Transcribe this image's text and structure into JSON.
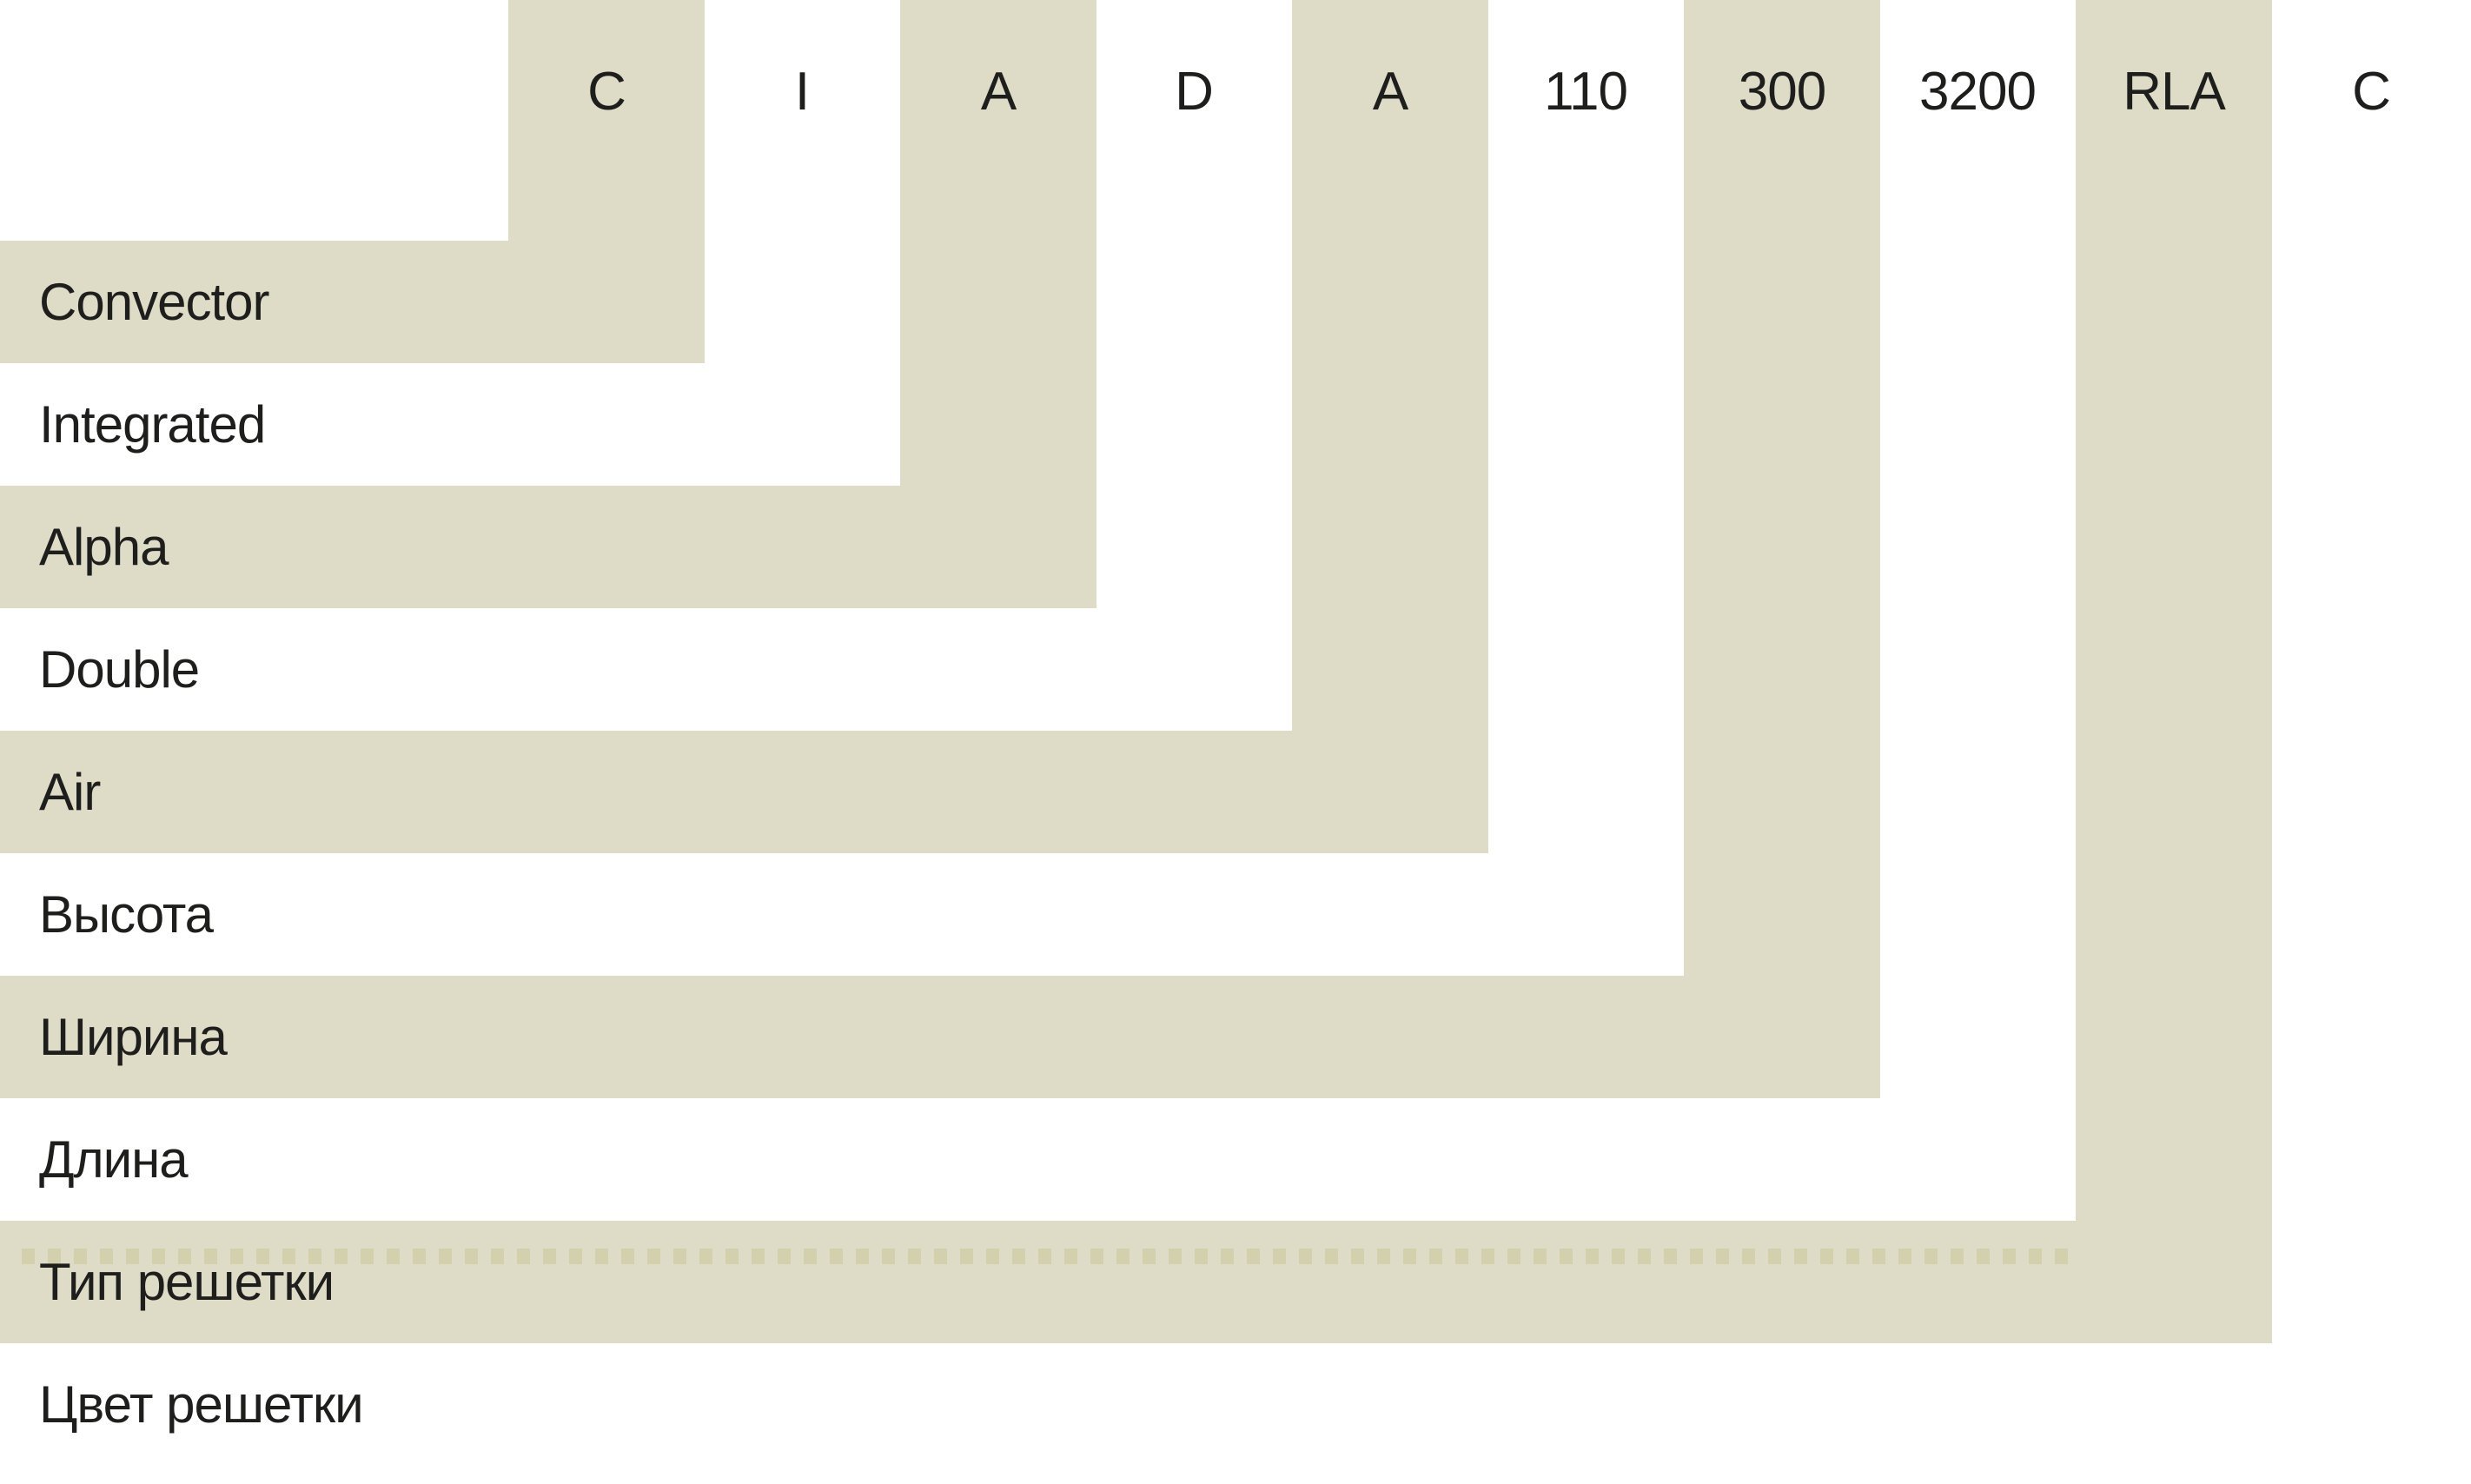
{
  "diagram": {
    "description": "Convector model code nomenclature stair diagram",
    "columns": [
      {
        "code": "C",
        "label": "Convector",
        "band": "beige"
      },
      {
        "code": "I",
        "label": "Integrated",
        "band": "white"
      },
      {
        "code": "A",
        "label": "Alpha",
        "band": "beige"
      },
      {
        "code": "D",
        "label": "Double",
        "band": "white"
      },
      {
        "code": "A",
        "label": "Air",
        "band": "beige"
      },
      {
        "code": "110",
        "label": "Высота",
        "band": "white"
      },
      {
        "code": "300",
        "label": "Ширина",
        "band": "beige"
      },
      {
        "code": "3200",
        "label": "Длина",
        "band": "white"
      },
      {
        "code": "RLA",
        "label": "Тип решетки",
        "band": "beige"
      },
      {
        "code": "C",
        "label": "Цвет решетки",
        "band": "white"
      }
    ]
  },
  "colors": {
    "band_beige": "#dedbc7",
    "dotted_line": "#d3d0ad",
    "text": "#1e1e1c",
    "background": "#ffffff"
  }
}
